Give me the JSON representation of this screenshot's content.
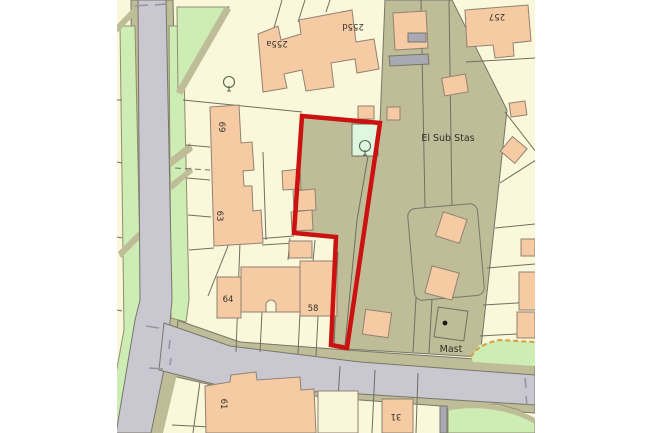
{
  "map": {
    "labels": {
      "el_sub_stas": "El Sub Stas",
      "mast": "Mast",
      "house_255a": "255a",
      "house_255d": "255d",
      "house_257": "257",
      "house_69": "69",
      "house_63": "63",
      "house_64": "64",
      "house_58": "58",
      "house_61": "61",
      "house_31": "31"
    },
    "colors": {
      "page_background": "#FFFFFF",
      "parcel_cream": "#FAF7DA",
      "building_peach": "#F6CBA3",
      "grass_green": "#CDEDB4",
      "mint_green": "#DFF6DF",
      "verge_khaki": "#BFBD98",
      "road_gray": "#C9C8D1",
      "boundary_red": "#CC1111",
      "dashed_border_orange": "#D89E3E",
      "line": "#6F6F60"
    }
  }
}
